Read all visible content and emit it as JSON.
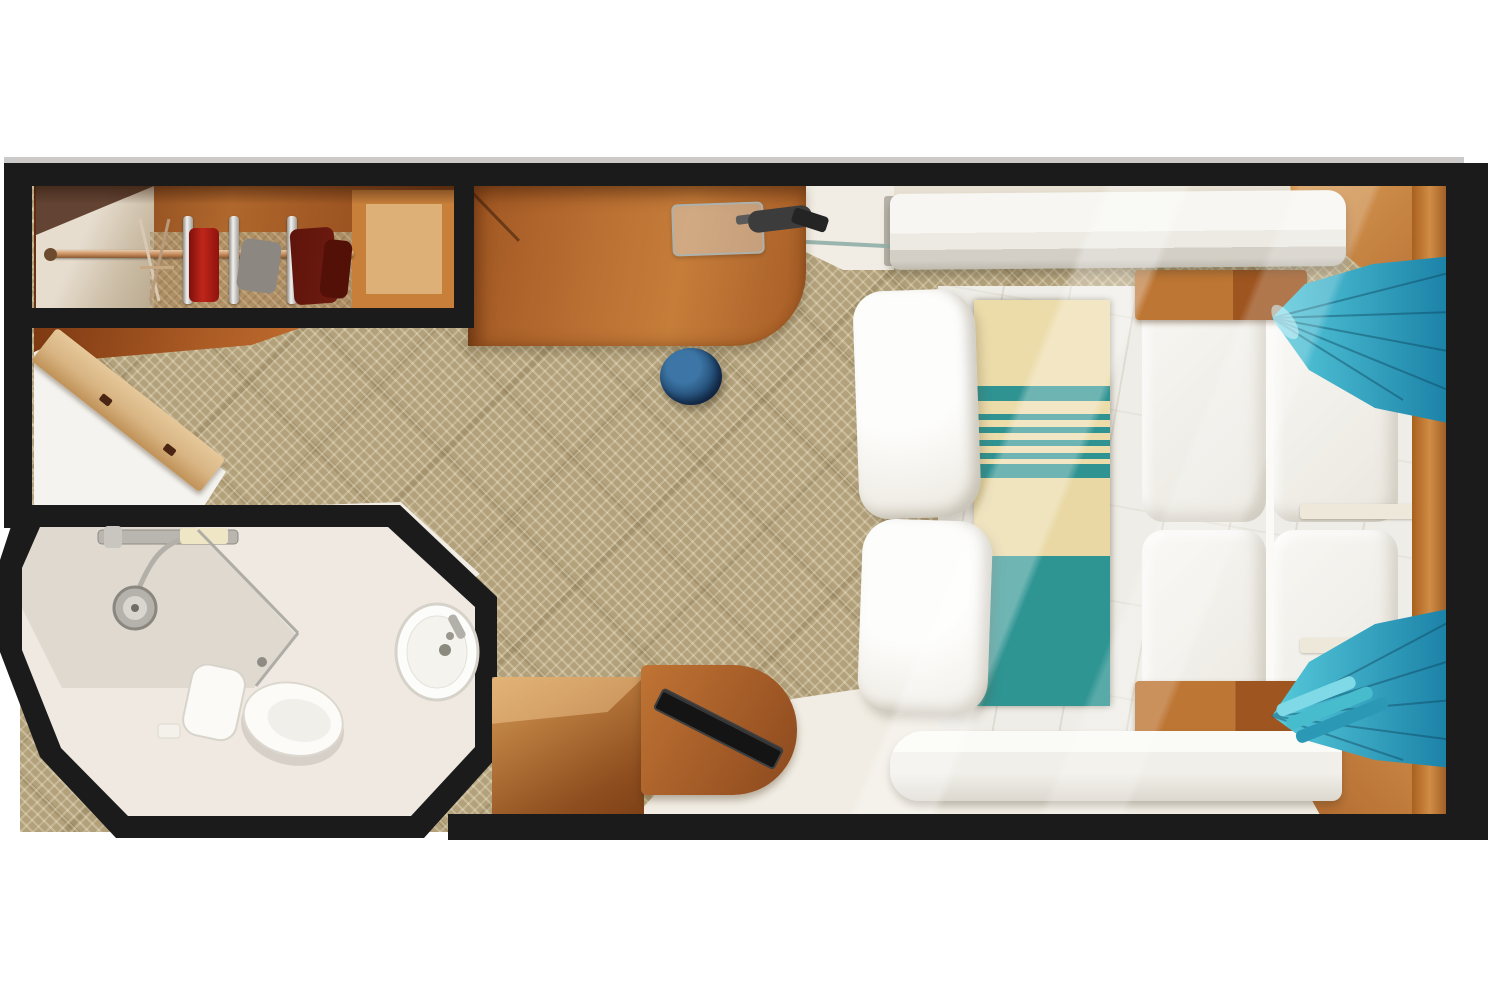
{
  "title": "Cruise ship stateroom floor plan (top-down 3D render)",
  "visible_text": [],
  "palette": {
    "canvas": "#ffffff",
    "wall": "#1b1b1b",
    "wall-hairline": "#cbcac8",
    "carpet": "#b2a17b",
    "wood-dark": "#7c3c14",
    "wood-mid": "#b0672c",
    "wood-pale": "#ddb078",
    "tile": "#f1ede4",
    "ceiling": "#e8e1d3",
    "bath-floor": "#efe9e1",
    "fixture": "#fbfaf7",
    "chrome": "#b3b0aa",
    "rod-copper": "#c58a5a",
    "garment-red": "#c0261a",
    "garment-maroon": "#6e1b10",
    "garment-gray": "#8d8781",
    "stool-dark": "#16304e",
    "stool-mid": "#234c74",
    "stool-light": "#3d76a6",
    "bed-white": "#efede7",
    "runner-cream": "#ecdcaa",
    "runner-teal": "#2f9391",
    "curtain-light": "#56cadb",
    "curtain-dark": "#1a80a6",
    "door-tan": "#d8b482",
    "tv-black": "#141414"
  },
  "rooms": [
    {
      "id": "main-cabin",
      "label": "Main cabin"
    },
    {
      "id": "bathroom",
      "label": "Bathroom"
    },
    {
      "id": "closet",
      "label": "Wardrobe closet"
    },
    {
      "id": "entry",
      "label": "Entry"
    }
  ],
  "labels": {
    "floorplan": "Stateroom floor plan",
    "closet": "Wardrobe closet with hanging rod",
    "closet_rod": "Closet hanging rod",
    "hangers": "Clothes hangers",
    "garments": "Hanging garments",
    "dresser": "Dresser with open door",
    "bathroom": "Bathroom",
    "shower": "Shower",
    "toilet": "Toilet",
    "sink": "Washbasin",
    "vanity_desk": "Vanity desk",
    "glass_shelf": "Glass shelf",
    "hair_dryer": "Hair dryer",
    "stool": "Vanity stool",
    "entry": "Entry tile floor",
    "bed": "Double bed",
    "pillows": "Pillows",
    "bed_runner": "Striped bed runner",
    "quilts": "Folded bedding panels",
    "nightstand_top": "Nightstand (upper)",
    "nightstand_bottom": "Nightstand (lower)",
    "pullman_shelf": "Overhead berth shelf",
    "bench": "Side bench seat",
    "curtain_top": "Curtain swag (upper corner)",
    "curtain_bottom": "Curtain swag (lower corner)",
    "tv": "Flat-screen TV",
    "tv_console": "TV console",
    "storage_cube": "Storage cabinet",
    "headboard": "Headboard wall trim",
    "walls": "Cabin walls"
  }
}
